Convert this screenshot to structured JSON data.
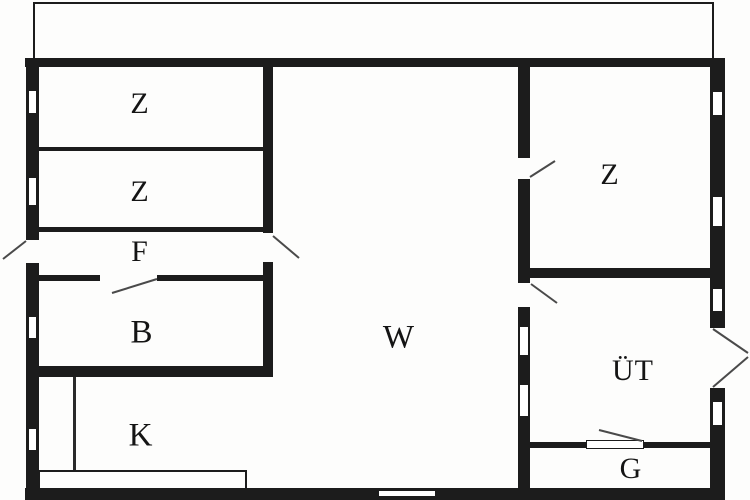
{
  "plan": {
    "kind": "floor-plan",
    "colors": {
      "wall": "#1c1c1c",
      "background": "#fdfdfc",
      "door_swing_line": "#4a4a4a",
      "label_text": "#141414"
    },
    "rooms": [
      {
        "id": "z1",
        "label": "Z"
      },
      {
        "id": "z2",
        "label": "Z"
      },
      {
        "id": "f",
        "label": "F"
      },
      {
        "id": "b",
        "label": "B"
      },
      {
        "id": "k",
        "label": "K"
      },
      {
        "id": "w",
        "label": "W"
      },
      {
        "id": "z3",
        "label": "Z"
      },
      {
        "id": "ut",
        "label": "ÜT"
      },
      {
        "id": "g",
        "label": "G"
      }
    ]
  }
}
